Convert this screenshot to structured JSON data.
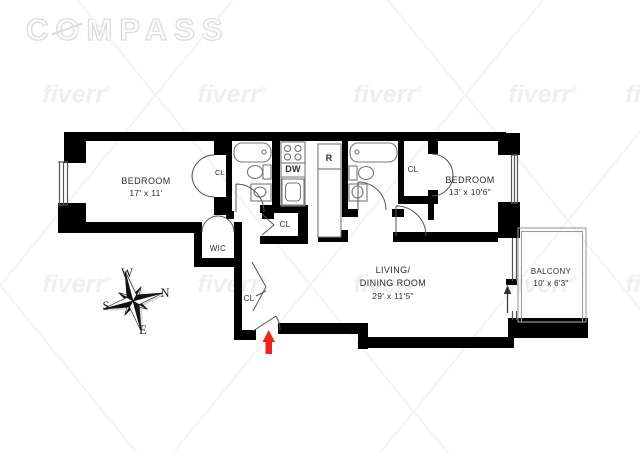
{
  "brand": {
    "logo_c": "C",
    "logo_o": "O",
    "logo_rest": "MPASS"
  },
  "watermark": {
    "text": "fiverr",
    "reg": "®"
  },
  "rooms": {
    "bedroom_left": {
      "label": "BEDROOM",
      "dims": "17' x 11'"
    },
    "bedroom_right": {
      "label": "BEDROOM",
      "dims": "13' x 10'6\""
    },
    "living_dining": {
      "line1": "LIVING/",
      "line2": "DINING ROOM",
      "dims": "29' x 11'5\""
    },
    "balcony": {
      "label": "BALCONY",
      "dims": "10' x 6'3\""
    },
    "walk_in_closet": {
      "label": "WIC"
    },
    "closet": {
      "label": "CL"
    }
  },
  "appliances": {
    "dishwasher": "DW",
    "refrigerator": "R"
  },
  "compass_rose": {
    "west": "W",
    "north": "N",
    "south": "S",
    "east": "E"
  },
  "colors": {
    "wall": "#000000",
    "entry_arrow": "#e8251e",
    "watermark": "#efefef",
    "logo_outline": "#dcdcdc"
  }
}
